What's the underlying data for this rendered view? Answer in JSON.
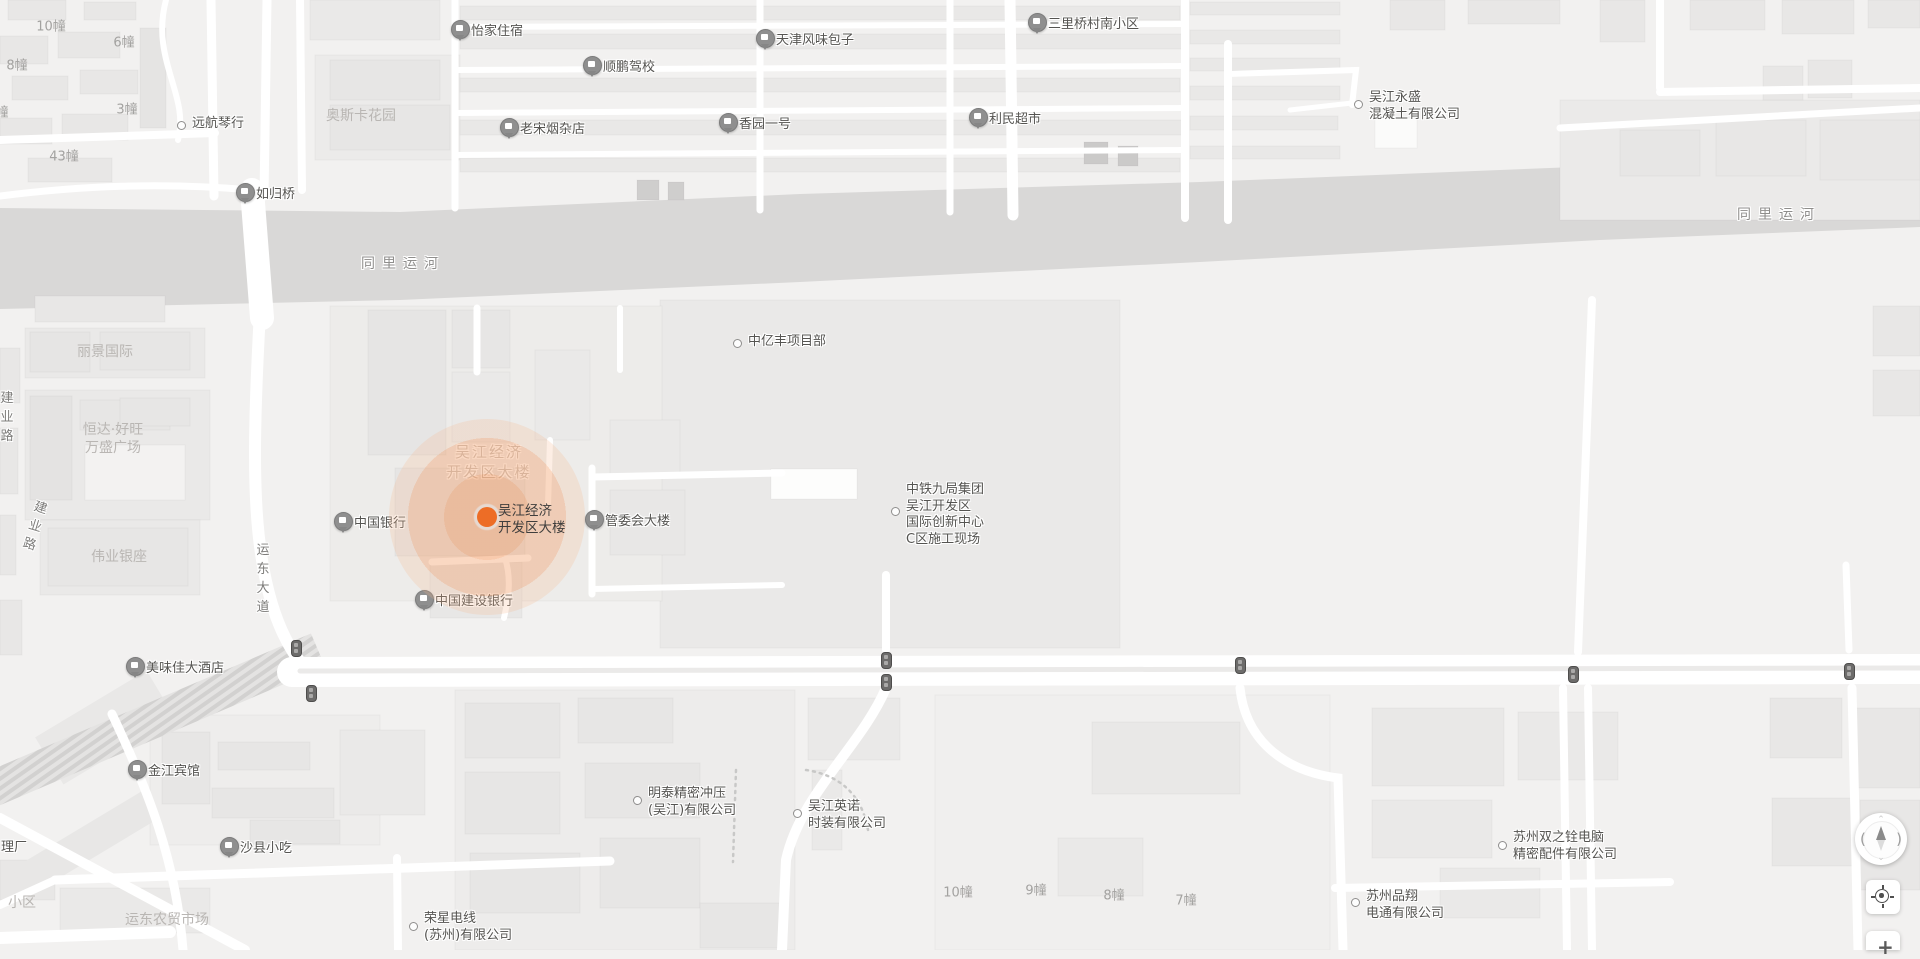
{
  "map": {
    "background": "#f2f1f0",
    "water_color": "#d9d8d7",
    "road_color": "#ffffff",
    "water_polygon": "0,208 400,212 800,194 1200,182 1600,166 1920,156 1920,227 1600,240 1200,262 800,282 400,300 0,309",
    "marker": {
      "name_line1": "吴江经济",
      "name_line2": "开发区大楼",
      "x": 487,
      "y": 517,
      "dot_color": "#ed6d26",
      "halo_color": "#f0823c"
    }
  },
  "controls": {
    "compass": {
      "left_glyph": "(",
      "right_glyph": ")",
      "up_glyph": "⌃",
      "down_glyph": "⌄"
    },
    "zoom_in_label": "+"
  },
  "traffic_lights": [
    [
      296,
      648
    ],
    [
      311,
      693
    ],
    [
      886,
      660
    ],
    [
      886,
      682
    ],
    [
      1240,
      665
    ],
    [
      1573,
      674
    ],
    [
      1849,
      671
    ]
  ],
  "parcels": [
    [
      660,
      300,
      460,
      348,
      "#eae9e8"
    ],
    [
      330,
      306,
      332,
      295,
      "#edecea"
    ],
    [
      25,
      390,
      185,
      130,
      "#eae9e8"
    ],
    [
      40,
      520,
      160,
      75,
      "#eae9e8"
    ],
    [
      25,
      328,
      180,
      50,
      "#eae9e8"
    ],
    [
      315,
      55,
      145,
      105,
      "#ecebea"
    ],
    [
      1560,
      100,
      360,
      120,
      "#ebeae9"
    ],
    [
      455,
      690,
      340,
      260,
      "#edeceb"
    ],
    [
      150,
      715,
      230,
      130,
      "#eeedec"
    ],
    [
      935,
      695,
      395,
      255,
      "#f0efee"
    ]
  ],
  "buildings": [
    [
      8,
      0,
      58,
      20,
      "#e8e7e6"
    ],
    [
      84,
      2,
      52,
      18,
      "#e8e7e6"
    ],
    [
      0,
      36,
      48,
      28,
      "#e8e7e6"
    ],
    [
      58,
      32,
      62,
      26,
      "#e8e7e6"
    ],
    [
      12,
      76,
      56,
      24,
      "#e8e7e6"
    ],
    [
      80,
      70,
      58,
      24,
      "#e8e7e6"
    ],
    [
      0,
      118,
      52,
      26,
      "#e8e7e6"
    ],
    [
      62,
      114,
      66,
      26,
      "#e8e7e6"
    ],
    [
      28,
      158,
      84,
      24,
      "#e8e7e6"
    ],
    [
      140,
      28,
      26,
      100,
      "#e5e4e3"
    ],
    [
      310,
      0,
      130,
      40,
      "#eae9e8"
    ],
    [
      330,
      60,
      110,
      40,
      "#e7e6e5"
    ],
    [
      330,
      105,
      120,
      45,
      "#e7e6e5"
    ],
    [
      460,
      6,
      720,
      14,
      "#e9e8e7"
    ],
    [
      460,
      34,
      722,
      15,
      "#e9e8e7"
    ],
    [
      460,
      78,
      720,
      14,
      "#e9e8e7"
    ],
    [
      460,
      120,
      722,
      15,
      "#e9e8e7"
    ],
    [
      460,
      158,
      720,
      14,
      "#e9e8e7"
    ],
    [
      1190,
      2,
      150,
      13,
      "#e9e8e7"
    ],
    [
      1190,
      30,
      150,
      14,
      "#e9e8e7"
    ],
    [
      1190,
      58,
      150,
      13,
      "#e9e8e7"
    ],
    [
      1190,
      86,
      150,
      14,
      "#e9e8e7"
    ],
    [
      1190,
      116,
      148,
      14,
      "#e9e8e7"
    ],
    [
      1190,
      146,
      150,
      13,
      "#e9e8e7"
    ],
    [
      637,
      180,
      22,
      20,
      "#cfcecd"
    ],
    [
      668,
      182,
      16,
      18,
      "#cfcecd"
    ],
    [
      1084,
      142,
      24,
      22,
      "#cbcac9"
    ],
    [
      1118,
      146,
      20,
      20,
      "#cbcac9"
    ],
    [
      1390,
      0,
      55,
      30,
      "#e8e7e6"
    ],
    [
      1468,
      0,
      92,
      24,
      "#e8e7e6"
    ],
    [
      1600,
      0,
      45,
      42,
      "#e8e7e6"
    ],
    [
      1690,
      0,
      75,
      30,
      "#e8e7e6"
    ],
    [
      1782,
      0,
      72,
      34,
      "#e8e7e6"
    ],
    [
      1868,
      0,
      52,
      28,
      "#e8e7e6"
    ],
    [
      1763,
      66,
      40,
      34,
      "#e8e7e6"
    ],
    [
      1808,
      60,
      44,
      38,
      "#e8e7e6"
    ],
    [
      1620,
      130,
      80,
      46,
      "#e7e6e5"
    ],
    [
      1716,
      120,
      90,
      56,
      "#e8e7e6"
    ],
    [
      1820,
      120,
      100,
      60,
      "#e8e7e6"
    ],
    [
      1375,
      118,
      42,
      30,
      "#fbfbfa"
    ],
    [
      0,
      348,
      20,
      55,
      "#e8e7e6"
    ],
    [
      0,
      428,
      18,
      66,
      "#e8e7e6"
    ],
    [
      0,
      515,
      16,
      60,
      "#e8e7e6"
    ],
    [
      0,
      600,
      22,
      55,
      "#e8e7e6"
    ],
    [
      35,
      296,
      130,
      26,
      "#e8e7e6"
    ],
    [
      30,
      332,
      60,
      40,
      "#e6e5e4"
    ],
    [
      100,
      332,
      90,
      38,
      "#e7e6e5"
    ],
    [
      30,
      396,
      42,
      104,
      "#e4e3e2"
    ],
    [
      80,
      400,
      90,
      30,
      "#e7e6e5"
    ],
    [
      85,
      445,
      100,
      55,
      "#f3f2f1"
    ],
    [
      120,
      398,
      70,
      28,
      "#e7e6e5"
    ],
    [
      48,
      528,
      140,
      58,
      "#e7e6e5"
    ],
    [
      368,
      310,
      78,
      145,
      "#e6e5e4"
    ],
    [
      452,
      310,
      58,
      58,
      "#e7e6e5"
    ],
    [
      452,
      372,
      58,
      70,
      "#eae9e8"
    ],
    [
      395,
      468,
      130,
      88,
      "#e6e5e4"
    ],
    [
      430,
      562,
      92,
      56,
      "#e8e7e6"
    ],
    [
      535,
      350,
      55,
      90,
      "#eae9e8"
    ],
    [
      610,
      490,
      75,
      65,
      "#e8e7e6"
    ],
    [
      610,
      420,
      70,
      55,
      "#eae9e8"
    ],
    [
      771,
      469,
      86,
      30,
      "#fdfdfc"
    ],
    [
      1873,
      306,
      47,
      50,
      "#e8e7e6"
    ],
    [
      1873,
      370,
      47,
      46,
      "#e8e7e6"
    ],
    [
      465,
      703,
      95,
      55,
      "#e7e6e5"
    ],
    [
      578,
      698,
      95,
      45,
      "#e7e6e5"
    ],
    [
      465,
      772,
      95,
      62,
      "#e7e6e5"
    ],
    [
      585,
      763,
      115,
      55,
      "#e7e6e5"
    ],
    [
      470,
      853,
      110,
      60,
      "#e7e6e5"
    ],
    [
      600,
      838,
      100,
      70,
      "#e7e6e5"
    ],
    [
      700,
      903,
      82,
      45,
      "#e7e6e5"
    ],
    [
      808,
      698,
      92,
      62,
      "#eae9e8"
    ],
    [
      812,
      770,
      30,
      80,
      "#eae9e8"
    ],
    [
      1092,
      722,
      148,
      72,
      "#e9e8e7"
    ],
    [
      1058,
      838,
      85,
      58,
      "#eae9e8"
    ],
    [
      1372,
      708,
      132,
      78,
      "#e9e8e7"
    ],
    [
      1518,
      712,
      100,
      68,
      "#eae9e8"
    ],
    [
      1372,
      800,
      120,
      58,
      "#eae9e8"
    ],
    [
      1440,
      868,
      100,
      50,
      "#eae9e8"
    ],
    [
      1770,
      698,
      72,
      60,
      "#e8e7e6"
    ],
    [
      1852,
      708,
      68,
      80,
      "#e8e7e6"
    ],
    [
      1772,
      798,
      82,
      68,
      "#e8e7e6"
    ],
    [
      1860,
      800,
      60,
      90,
      "#e8e7e6"
    ],
    [
      162,
      732,
      48,
      72,
      "#e7e6e5"
    ],
    [
      218,
      742,
      92,
      28,
      "#e7e6e5"
    ],
    [
      212,
      788,
      122,
      30,
      "#e7e6e5"
    ],
    [
      250,
      820,
      90,
      24,
      "#e7e6e5"
    ],
    [
      340,
      730,
      85,
      85,
      "#eae9e8"
    ],
    [
      60,
      888,
      150,
      45,
      "#eae9e8"
    ],
    [
      0,
      860,
      55,
      40,
      "#e8e7e6"
    ]
  ],
  "rot_buildings": [
    [
      40,
      700,
      130,
      55,
      -31,
      "#e9e8e7"
    ],
    [
      10,
      828,
      150,
      32,
      -31,
      "#e8e7e6"
    ]
  ],
  "roads": [
    {
      "d": "M 211,0 L 214,196",
      "w": 9
    },
    {
      "d": "M 267,0 L 264,196",
      "w": 9
    },
    {
      "d": "M 300,0 L 302,190",
      "w": 8
    },
    {
      "d": "M 0,140 L 215,133",
      "w": 8
    },
    {
      "d": "M 166,0 C 150,60 190,95 178,140",
      "w": 6
    },
    {
      "d": "M 0,196 C 80,186 160,182 252,190",
      "w": 7
    },
    {
      "d": "M 455,0 L 455,208",
      "w": 7
    },
    {
      "d": "M 760,0 L 760,210",
      "w": 7
    },
    {
      "d": "M 950,0 L 950,212",
      "w": 7
    },
    {
      "d": "M 1185,0 L 1185,218",
      "w": 8
    },
    {
      "d": "M 1010,0 L 1013,215",
      "w": 11
    },
    {
      "d": "M 1228,44 L 1228,220",
      "w": 8
    },
    {
      "d": "M 455,27 L 1185,24",
      "w": 6
    },
    {
      "d": "M 455,70 L 1185,66",
      "w": 6
    },
    {
      "d": "M 455,113 L 1185,108",
      "w": 6
    },
    {
      "d": "M 455,155 L 1185,150",
      "w": 6
    },
    {
      "d": "M 1228,74 L 1356,70 L 1352,105",
      "w": 6
    },
    {
      "d": "M 1352,103 L 1290,110",
      "w": 5
    },
    {
      "d": "M 1660,0 L 1660,88",
      "w": 8
    },
    {
      "d": "M 1660,92 L 1920,88",
      "w": 8
    },
    {
      "d": "M 1560,128 L 1920,108",
      "w": 7
    },
    {
      "d": "M 252,190 L 262,318",
      "w": 24
    },
    {
      "d": "M 260,312 C 254,420 252,500 262,560 C 270,610 285,645 305,668",
      "w": 12
    },
    {
      "d": "M 477,308 L 477,372",
      "w": 7
    },
    {
      "d": "M 620,308 L 620,370",
      "w": 6
    },
    {
      "d": "M 592,468 L 592,594",
      "w": 7
    },
    {
      "d": "M 592,477 L 782,473",
      "w": 7
    },
    {
      "d": "M 592,589 L 782,585",
      "w": 6
    },
    {
      "d": "M 432,562 L 528,558",
      "w": 7
    },
    {
      "d": "M 505,558 C 512,580 508,600 504,618",
      "w": 6
    },
    {
      "d": "M 550,440 L 548,505",
      "w": 6
    },
    {
      "d": "M 886,575 L 886,650",
      "w": 8
    },
    {
      "d": "M 1592,300 L 1578,652",
      "w": 8
    },
    {
      "d": "M 1846,565 L 1849,650",
      "w": 7
    },
    {
      "d": "M 292,672 L 1920,669",
      "w": 30
    },
    {
      "d": "M 300,671 L 1920,668",
      "w": 5,
      "c": "#ebeae9"
    },
    {
      "d": "M 112,714 C 148,790 176,860 183,950",
      "w": 9
    },
    {
      "d": "M 55,880 L 610,861",
      "w": 9
    },
    {
      "d": "M 55,880 L 0,905",
      "w": 8
    },
    {
      "d": "M 397,858 L 398,950",
      "w": 8
    },
    {
      "d": "M 886,688 C 862,745 800,795 786,860 L 782,950",
      "w": 10
    },
    {
      "d": "M 1240,688 C 1246,745 1290,772 1338,778 L 1343,950",
      "w": 9
    },
    {
      "d": "M 1335,888 L 1670,882",
      "w": 8
    },
    {
      "d": "M 1563,688 L 1567,950",
      "w": 8
    },
    {
      "d": "M 1588,688 L 1592,950",
      "w": 8
    },
    {
      "d": "M 1852,688 L 1858,950",
      "w": 9
    },
    {
      "d": "M 0,818 L 245,950",
      "w": 10
    },
    {
      "d": "M 0,938 L 170,932",
      "w": 12
    },
    {
      "d": "M 736,770 L 733,862",
      "w": 2.5,
      "c": "#c8c8c7",
      "dash": "2,5"
    },
    {
      "d": "M 806,770 C 840,775 862,795 868,830",
      "w": 2.5,
      "c": "#c8c8c7",
      "dash": "2,5"
    }
  ],
  "hatch_band": {
    "d": "M 318,650 L -10,790",
    "w": 36
  },
  "labels": [
    {
      "type": "pin",
      "icon": "lodging-icon",
      "x": 460,
      "y": 29,
      "text": "怡家住宿"
    },
    {
      "type": "pin",
      "icon": "driving-school-icon",
      "x": 592,
      "y": 65,
      "text": "顺鹏驾校"
    },
    {
      "type": "pin",
      "icon": "food-icon",
      "x": 765,
      "y": 38,
      "text": "天津风味包子"
    },
    {
      "type": "pin",
      "icon": "shop-icon",
      "x": 509,
      "y": 127,
      "text": "老宋烟杂店"
    },
    {
      "type": "pin",
      "icon": "residence-icon",
      "x": 728,
      "y": 122,
      "text": "香园一号"
    },
    {
      "type": "pin",
      "icon": "supermarket-icon",
      "x": 978,
      "y": 117,
      "text": "利民超市"
    },
    {
      "type": "pin",
      "icon": "residence-icon",
      "x": 1037,
      "y": 22,
      "text": "三里桥村南小区"
    },
    {
      "type": "pin",
      "icon": "bridge-icon",
      "x": 245,
      "y": 192,
      "text": "如归桥"
    },
    {
      "type": "pin",
      "icon": "bank-icon",
      "x": 343,
      "y": 521,
      "text": "中国银行"
    },
    {
      "type": "pin",
      "icon": "government-icon",
      "x": 594,
      "y": 519,
      "text": "管委会大楼"
    },
    {
      "type": "pin",
      "icon": "bank-icon",
      "x": 424,
      "y": 599,
      "text": "中国建设银行"
    },
    {
      "type": "pin",
      "icon": "restaurant-icon",
      "x": 135,
      "y": 666,
      "text": "美味佳大酒店"
    },
    {
      "type": "pin",
      "icon": "hotel-icon",
      "x": 137,
      "y": 769,
      "text": "金江宾馆"
    },
    {
      "type": "pin",
      "icon": "snack-icon",
      "x": 229,
      "y": 846,
      "text": "沙县小吃"
    },
    {
      "type": "dot",
      "x": 181,
      "y": 125,
      "text": "远航琴行"
    },
    {
      "type": "dot",
      "x": 737,
      "y": 343,
      "text": "中亿丰项目部"
    },
    {
      "type": "dot",
      "x": 1358,
      "y": 104,
      "dy": -14,
      "lines": [
        "吴江永盛",
        "混凝土有限公司"
      ]
    },
    {
      "type": "dot",
      "x": 895,
      "y": 511,
      "dy": -29,
      "lines": [
        "中铁九局集团",
        "吴江开发区",
        "国际创新中心",
        "C区施工现场"
      ]
    },
    {
      "type": "dot",
      "x": 637,
      "y": 800,
      "dy": -14,
      "lines": [
        "明泰精密冲压",
        "(吴江)有限公司"
      ]
    },
    {
      "type": "dot",
      "x": 797,
      "y": 813,
      "dy": -14,
      "lines": [
        "吴江英诺",
        "时装有限公司"
      ]
    },
    {
      "type": "dot",
      "x": 413,
      "y": 926,
      "dy": -15,
      "lines": [
        "荣星电线",
        "(苏州)有限公司"
      ]
    },
    {
      "type": "dot",
      "x": 1502,
      "y": 845,
      "dy": -15,
      "lines": [
        "苏州双之铨电脑",
        "精密配件有限公司"
      ]
    },
    {
      "type": "dot",
      "x": 1355,
      "y": 902,
      "dy": -13,
      "lines": [
        "苏州品翔",
        "电通有限公司"
      ]
    },
    {
      "type": "area",
      "x": 361,
      "y": 116,
      "text": "奥斯卡花园"
    },
    {
      "type": "area",
      "x": 105,
      "y": 352,
      "text": "丽景国际"
    },
    {
      "type": "area",
      "x": 113,
      "y": 439,
      "lines": [
        "恒达·好旺",
        "万盛广场"
      ]
    },
    {
      "type": "area",
      "x": 119,
      "y": 557,
      "text": "伟业银座"
    },
    {
      "type": "area",
      "x": 167,
      "y": 920,
      "text": "运东农贸市场"
    },
    {
      "type": "area-left",
      "x": 8,
      "y": 903,
      "text": "小区"
    },
    {
      "type": "poi-text",
      "x": 1,
      "y": 845,
      "text": "理厂"
    },
    {
      "type": "bnum",
      "x": 51,
      "y": 25,
      "text": "10幢"
    },
    {
      "type": "bnum",
      "x": 124,
      "y": 41,
      "text": "6幢"
    },
    {
      "type": "bnum",
      "x": 17,
      "y": 64,
      "text": "8幢"
    },
    {
      "type": "bnum",
      "x": 2,
      "y": 111,
      "text": "幢"
    },
    {
      "type": "bnum",
      "x": 127,
      "y": 108,
      "text": "3幢"
    },
    {
      "type": "bnum",
      "x": 64,
      "y": 155,
      "text": "43幢"
    },
    {
      "type": "bnum",
      "x": 958,
      "y": 891,
      "text": "10幢"
    },
    {
      "type": "bnum",
      "x": 1036,
      "y": 889,
      "text": "9幢"
    },
    {
      "type": "bnum",
      "x": 1114,
      "y": 894,
      "text": "8幢"
    },
    {
      "type": "bnum",
      "x": 1186,
      "y": 899,
      "text": "7幢"
    },
    {
      "type": "water",
      "x": 403,
      "y": 263,
      "text": "同里运河"
    },
    {
      "type": "water",
      "x": 1779,
      "y": 214,
      "text": "同里运河"
    },
    {
      "type": "road-v",
      "x": 263,
      "y": 541,
      "text": "运东大道"
    },
    {
      "type": "road-v",
      "x": 7,
      "y": 389,
      "text": "建业路"
    },
    {
      "type": "road-v",
      "x": 35,
      "y": 498,
      "rot": 17,
      "text": "建业路"
    },
    {
      "type": "ghost",
      "x": 489,
      "y": 462,
      "lines": [
        "吴江经济",
        "开发区大楼"
      ]
    }
  ]
}
